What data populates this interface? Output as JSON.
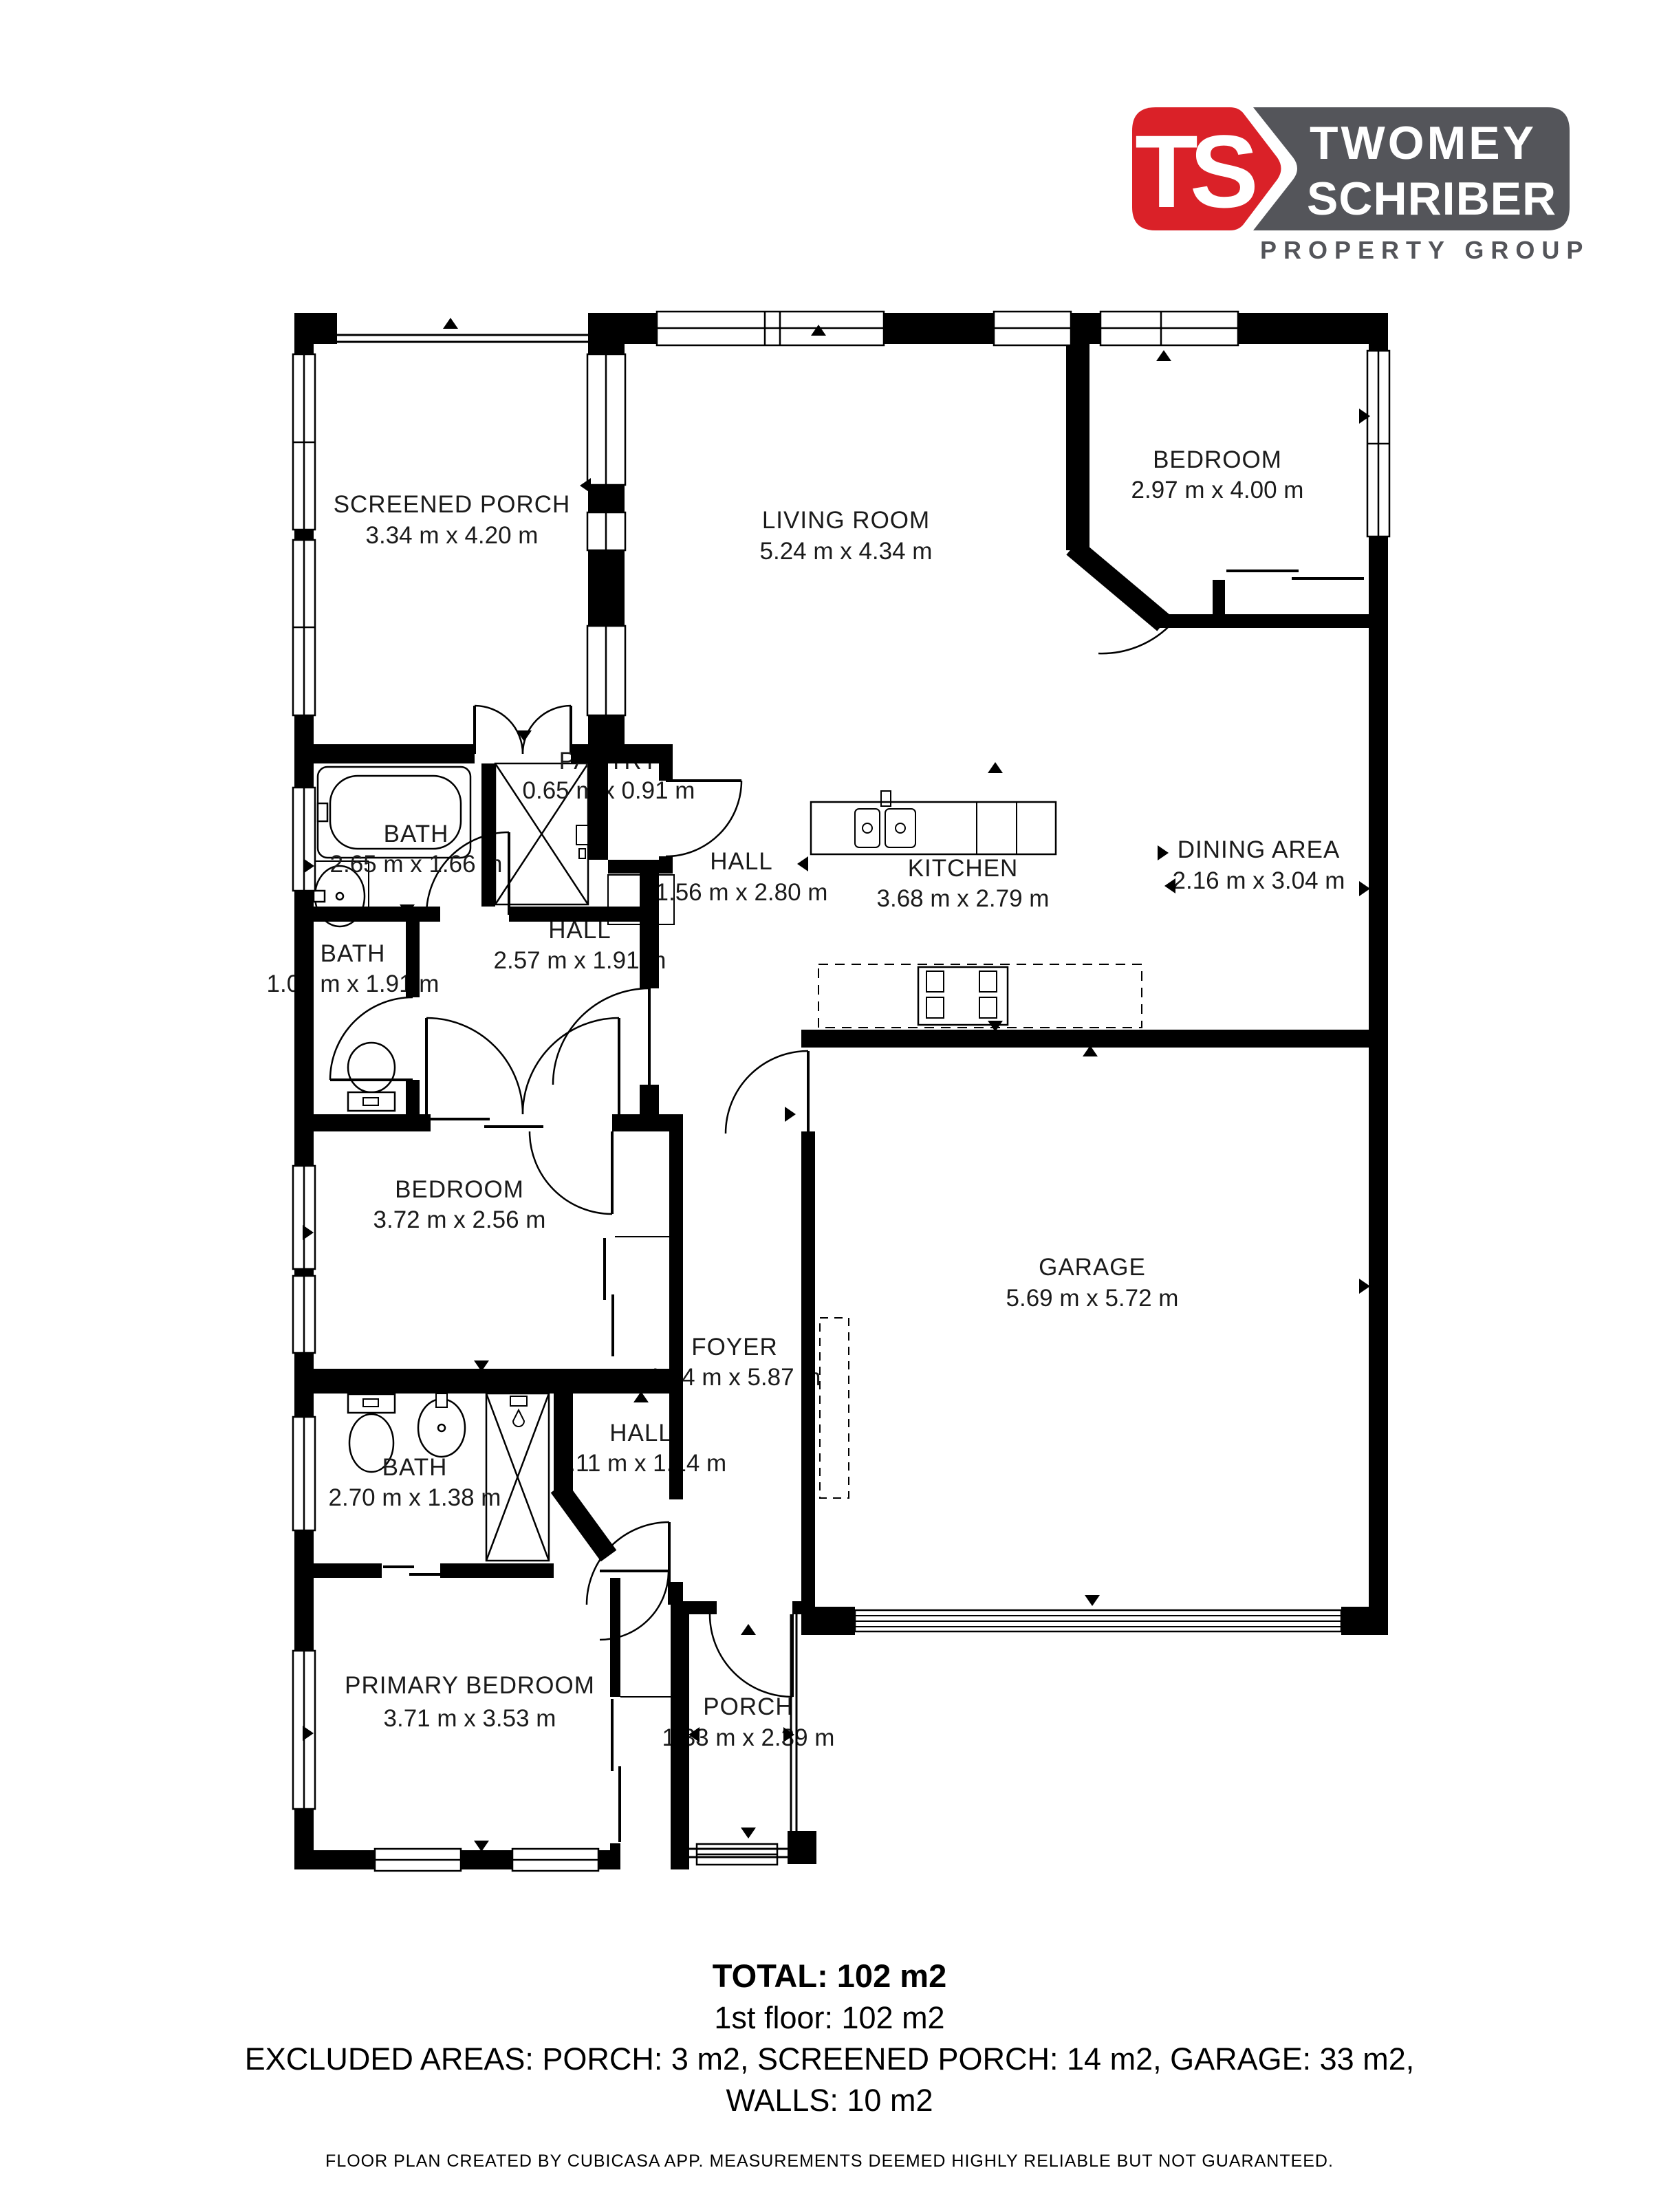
{
  "logo": {
    "monogram": "TS",
    "name_line1": "TWOMEY",
    "name_line2": "SCHRIBER",
    "tagline": "PROPERTY GROUP",
    "brand_red": "#da2128",
    "brand_gray": "#54555a"
  },
  "rooms": [
    {
      "name": "SCREENED PORCH",
      "dims": "3.34 m x 4.20 m"
    },
    {
      "name": "LIVING ROOM",
      "dims": "5.24 m x 4.34 m"
    },
    {
      "name": "BEDROOM",
      "dims": "2.97 m x 4.00 m"
    },
    {
      "name": "PANTRY",
      "dims": "0.65 m x 0.91 m"
    },
    {
      "name": "BATH",
      "dims": "2.65 m x 1.66 m"
    },
    {
      "name": "HALL",
      "dims": "1.56 m x 2.80 m"
    },
    {
      "name": "KITCHEN",
      "dims": "3.68 m x 2.79 m"
    },
    {
      "name": "DINING AREA",
      "dims": "2.16 m x 3.04 m"
    },
    {
      "name": "BATH",
      "dims": "1.05 m x 1.91 m"
    },
    {
      "name": "HALL",
      "dims": "2.57 m x 1.91 m"
    },
    {
      "name": "BEDROOM",
      "dims": "3.72 m x 2.56 m"
    },
    {
      "name": "GARAGE",
      "dims": "5.69 m x 5.72 m"
    },
    {
      "name": "FOYER",
      "dims": "1.24 m x 5.87 m"
    },
    {
      "name": "HALL",
      "dims": "1.11 m x 1.14 m"
    },
    {
      "name": "BATH",
      "dims": "2.70 m x 1.38 m"
    },
    {
      "name": "PRIMARY BEDROOM",
      "dims": "3.71 m x 3.53 m"
    },
    {
      "name": "PORCH",
      "dims": "1.33 m x 2.39 m"
    }
  ],
  "summary": {
    "total": "TOTAL: 102 m2",
    "floor": "1st floor: 102 m2",
    "excluded": "EXCLUDED AREAS: PORCH: 3 m2, SCREENED PORCH: 14 m2, GARAGE: 33 m2,",
    "walls": "WALLS: 10 m2"
  },
  "footer": "FLOOR PLAN CREATED BY CUBICASA APP. MEASUREMENTS DEEMED HIGHLY RELIABLE BUT NOT GUARANTEED."
}
